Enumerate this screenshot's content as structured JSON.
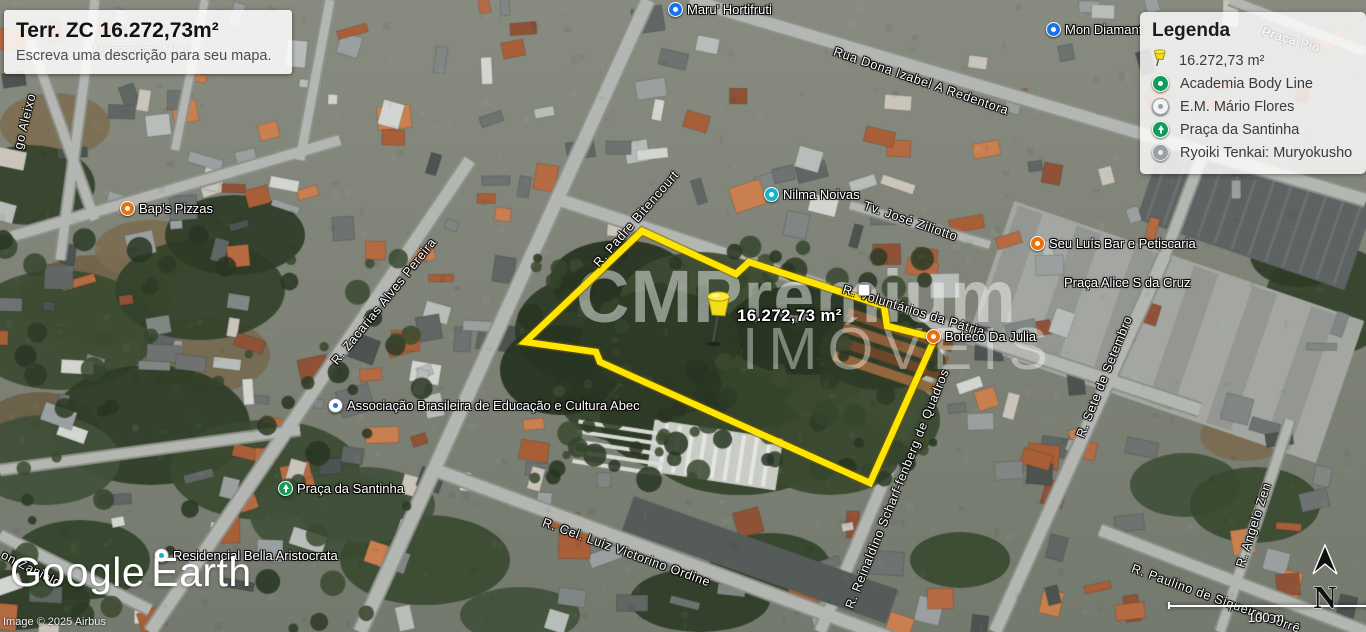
{
  "title_box": {
    "title": "Terr. ZC 16.272,73m²",
    "subtitle": "Escreva uma descrição para seu mapa."
  },
  "legend": {
    "title": "Legenda",
    "items": [
      {
        "icon": "pushpin-yellow",
        "label": "16.272,73 m²"
      },
      {
        "icon": "poi-green",
        "label": "Academia Body Line"
      },
      {
        "icon": "poi-white",
        "label": "E.M. Mário Flores"
      },
      {
        "icon": "poi-green-tree",
        "label": "Praça da Santinha"
      },
      {
        "icon": "poi-gray",
        "label": "Ryoiki Tenkai: Muryokusho"
      }
    ]
  },
  "map": {
    "area_label": "16.272,73 m²",
    "watermark": {
      "line1": "CMPremium",
      "line2": "IMÓVEIS"
    },
    "polygon_points": [
      [
        642,
        231
      ],
      [
        736,
        274
      ],
      [
        749,
        262
      ],
      [
        884,
        306
      ],
      [
        887,
        326
      ],
      [
        935,
        338
      ],
      [
        870,
        483
      ],
      [
        600,
        362
      ],
      [
        596,
        352
      ],
      [
        525,
        342
      ]
    ],
    "poi_labels": [
      {
        "name": "maru-hortifruti",
        "icon": "store-blue",
        "text": "Maru' Hortifruti",
        "x": 668,
        "y": 2
      },
      {
        "name": "mon-diamant",
        "icon": "store-blue",
        "text": "Mon Diamant",
        "x": 1046,
        "y": 22
      },
      {
        "name": "baps-pizzas",
        "icon": "food-orange",
        "text": "Bap's Pizzas",
        "x": 120,
        "y": 201
      },
      {
        "name": "nilma-noivas",
        "icon": "store-teal",
        "text": "Nilma Noivas",
        "x": 764,
        "y": 187
      },
      {
        "name": "seu-luis-bar",
        "icon": "food-orange",
        "text": "Seu Luís Bar e Petiscaria",
        "x": 1030,
        "y": 236
      },
      {
        "name": "praca-alice-s-da-cruz",
        "icon": null,
        "text": "Praça Alice S da Cruz",
        "x": 1064,
        "y": 275
      },
      {
        "name": "boteco-da-julia",
        "icon": "food-orange",
        "text": "Boteco Da Julia",
        "x": 926,
        "y": 329
      },
      {
        "name": "associacao-abec",
        "icon": "school-white",
        "text": "Associação Brasileira de Educação e Cultura Abec",
        "x": 328,
        "y": 398
      },
      {
        "name": "praca-da-santinha",
        "icon": "park-green",
        "text": "Praça da Santinha",
        "x": 278,
        "y": 481
      },
      {
        "name": "residencial-bella-aristocrata",
        "icon": "lodging-white",
        "text": "Residencial Bella Aristocrata",
        "x": 154,
        "y": 548
      },
      {
        "name": "massagista",
        "icon": null,
        "text": "Massagista Muni",
        "x": 93,
        "y": 42,
        "muted": true
      },
      {
        "name": "road-marker",
        "icon": "shield-white",
        "text": "",
        "x": 858,
        "y": 284
      }
    ],
    "street_labels": [
      {
        "name": "rua-dona-izabel-a-redentora",
        "text": "Rua Dona Izabel A Redentora",
        "x": 834,
        "y": 44,
        "angle": 19
      },
      {
        "name": "praca-pio",
        "text": "Praça Pio",
        "x": 1262,
        "y": 24,
        "angle": 17
      },
      {
        "name": "tv-jose-ziliotto",
        "text": "Tv. José Ziliotto",
        "x": 864,
        "y": 198,
        "angle": 19
      },
      {
        "name": "r-padre-bitencourt",
        "text": "R. Padre Bitencourt",
        "x": 596,
        "y": 258,
        "angle": -49
      },
      {
        "name": "r-voluntarios-da-patria",
        "text": "R. Voluntários da Pátria",
        "x": 843,
        "y": 282,
        "angle": 17
      },
      {
        "name": "r-sete-de-setembro",
        "text": "R. Sete de Setembro",
        "x": 1080,
        "y": 430,
        "angle": -68
      },
      {
        "name": "r-zacarias-alves-pereira",
        "text": "R. Zacarias Alves Pereira",
        "x": 334,
        "y": 356,
        "angle": -51
      },
      {
        "name": "r-reinaldino-scharffenberg-de-quadros",
        "text": "R. Reinaldino Scharf-fenberg de Quadros",
        "x": 849,
        "y": 601,
        "angle": -68
      },
      {
        "name": "r-cel-luiz-victorino-ordine",
        "text": "R. Cel. Luiz Victorino Ordine",
        "x": 543,
        "y": 515,
        "angle": 20
      },
      {
        "name": "r-paulino-de-siqueira-corre",
        "text": "R. Paulino de Siqueira Corrê",
        "x": 1132,
        "y": 561,
        "angle": 20
      },
      {
        "name": "r-angelo-zen",
        "text": "R. Angelo Zen",
        "x": 1240,
        "y": 560,
        "angle": -72
      },
      {
        "name": "on-zaniolo",
        "text": "on Zaniolo",
        "x": 2,
        "y": 547,
        "angle": 27
      },
      {
        "name": "go-aleixo",
        "text": "go Aleixo",
        "x": 18,
        "y": 142,
        "angle": -76
      }
    ]
  },
  "colors": {
    "polygon": "#ffe600",
    "polygon_shadow": "rgba(125,92,0,0.5)",
    "poi_green": "#0f9d58",
    "poi_blue": "#1a73e8",
    "poi_teal": "#12b5cb",
    "poi_orange": "#e8710a",
    "poi_gray": "#9aa0a6"
  },
  "footer": {
    "google": "Google",
    "earth": "Earth",
    "copyright": "Image © 2025 Airbus"
  },
  "scale_bar": {
    "label": "100 m"
  },
  "compass": {
    "label": "N"
  }
}
